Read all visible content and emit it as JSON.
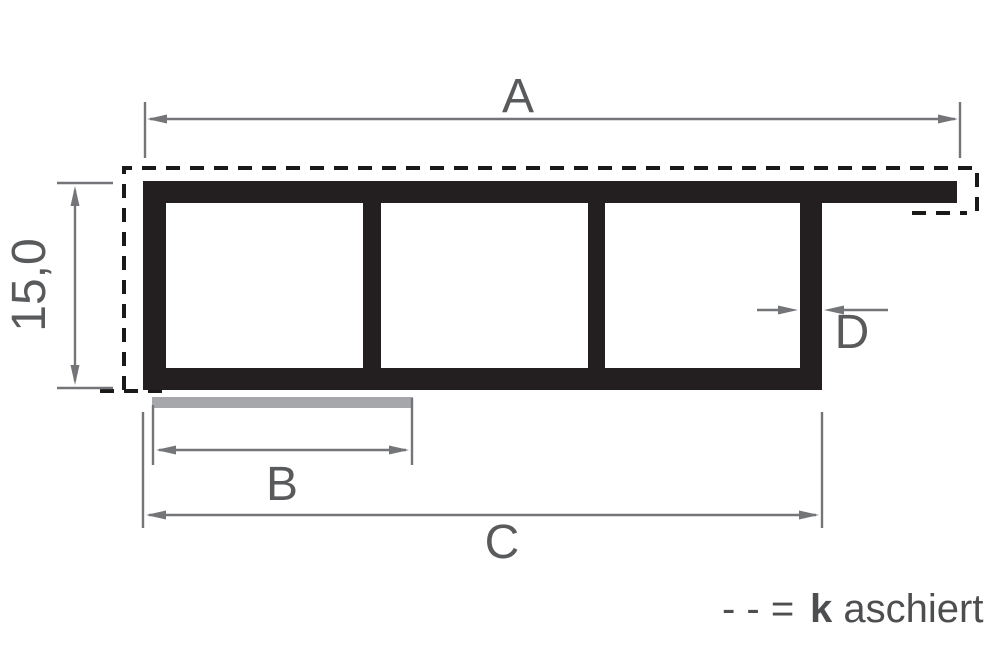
{
  "figure": {
    "type": "profile-cross-section-technical-drawing",
    "description": "Hollow chamber profile with three chambers, laminated top/left surface and foil overlay bar",
    "dimensions": {
      "total_width_label": "A",
      "overlay_width_label": "B",
      "body_width_label": "C",
      "wall_thickness_label": "D",
      "height_value": "15,0"
    },
    "legend": {
      "dash_symbol": "- - =",
      "term_bold_initial": "k",
      "term_rest": "aschiert"
    },
    "colors": {
      "profile_ink": "#231f20",
      "laminate_dash": "#1b1918",
      "dimension_lines": "#747578",
      "labels": "#595a5c",
      "legend_text": "#4d4e50",
      "overlay_bar": "#a5a7aa",
      "background": "#ffffff"
    }
  }
}
